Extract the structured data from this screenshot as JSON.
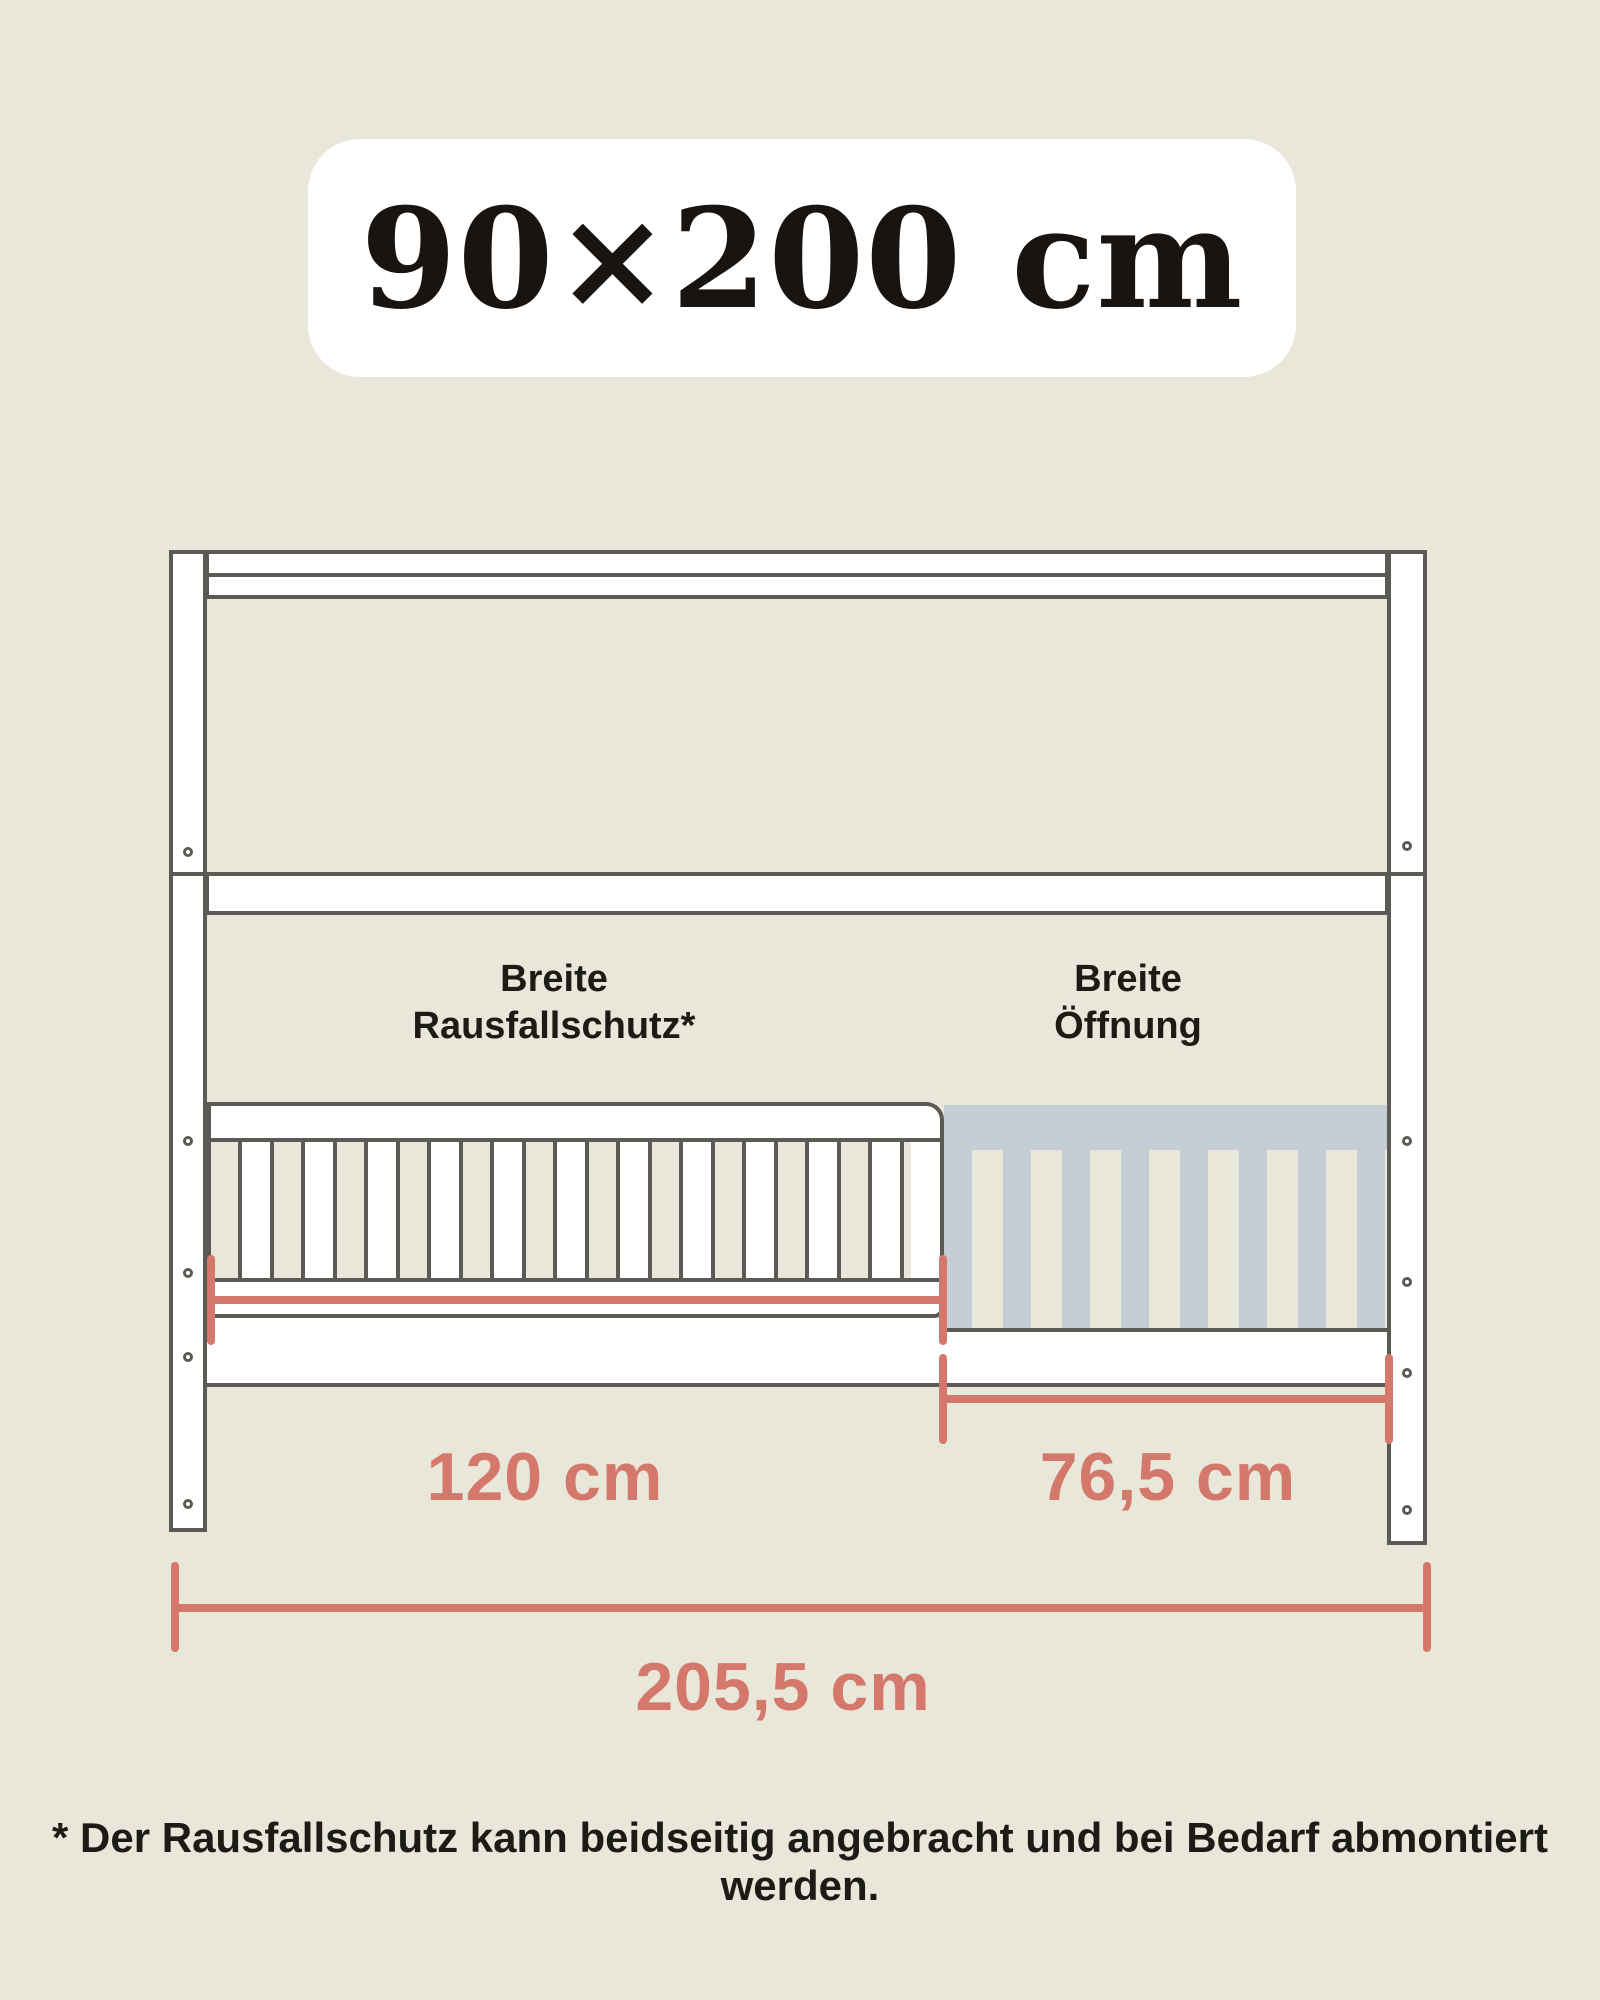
{
  "colors": {
    "bg": "#e9e6da",
    "stroke": "#5b5a55",
    "surface": "#ffffff",
    "gray": "#c5ced4",
    "accent": "#d4786c",
    "ink": "#1d1b16",
    "title-ink": "#1a1410"
  },
  "badge": {
    "title": "90×200 cm"
  },
  "labels": {
    "guard": {
      "line1": "Breite",
      "line2": "Rausfallschutz*"
    },
    "opening": {
      "line1": "Breite",
      "line2": "Öffnung"
    }
  },
  "dimensions": {
    "guard": {
      "label": "120 cm"
    },
    "opening": {
      "label": "76,5 cm"
    },
    "total": {
      "label": "205,5 cm"
    }
  },
  "footnote": {
    "text": "* Der Rausfallschutz kann beidseitig angebracht und bei Bedarf abmontiert werden."
  }
}
